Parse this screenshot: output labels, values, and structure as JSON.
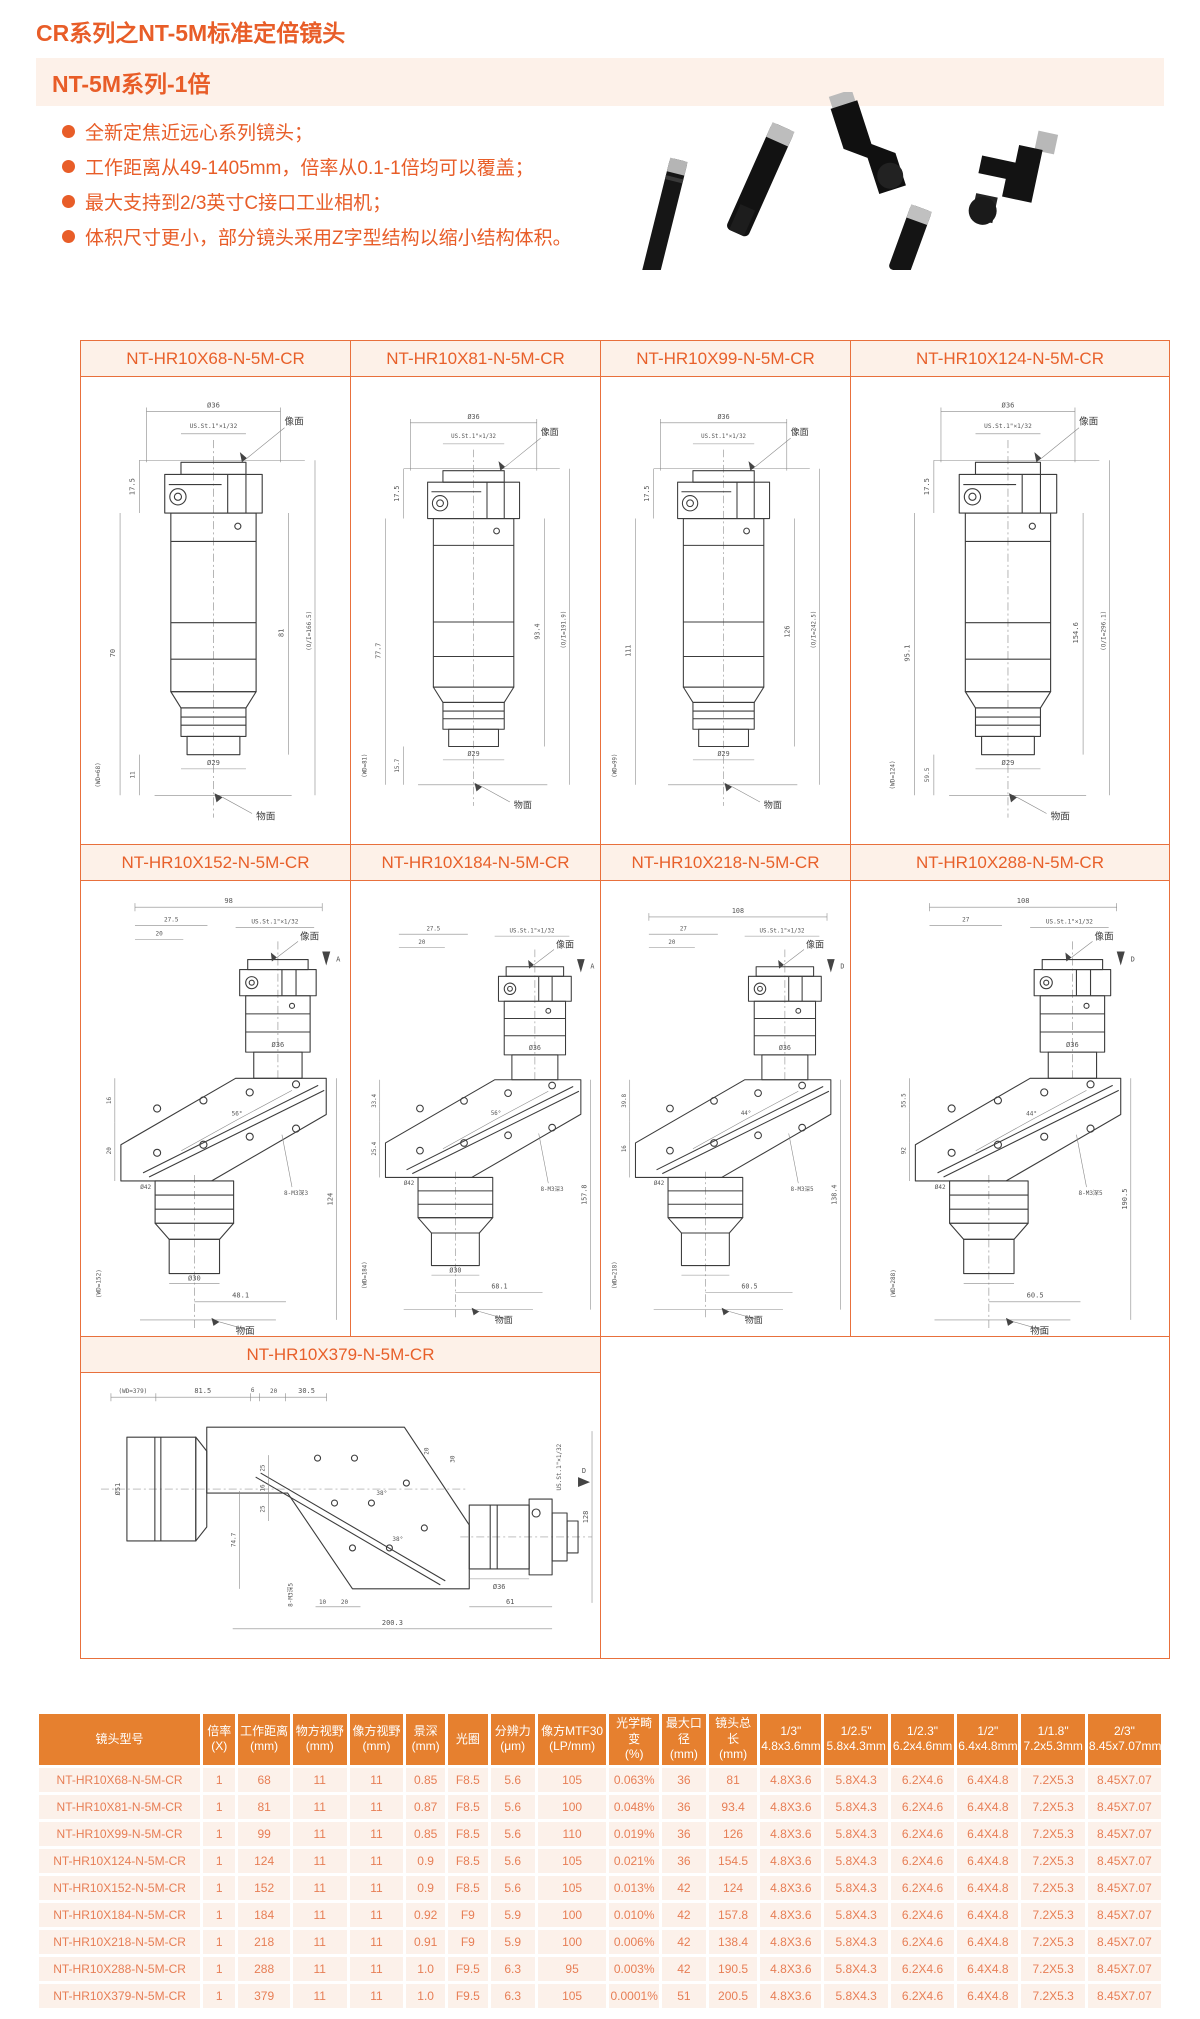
{
  "page": {
    "title": "CR系列之NT-5M标准定倍镜头",
    "banner": "NT-5M系列-1倍",
    "bullets": [
      "全新定焦近远心系列镜头；",
      "工作距离从49-1405mm，倍率从0.1-1倍均可以覆盖；",
      "最大支持到2/3英寸C接口工业相机；",
      "体积尺寸更小，部分镜头采用Z字型结构以缩小结构体积。"
    ]
  },
  "colors": {
    "accent": "#e85d28",
    "banner_bg": "#fdf1e9",
    "grid_border": "#e8703c",
    "grid_title_bg": "#fdf1e8",
    "table_header_bg": "#e6802f",
    "table_row_bg": "#fcf1ea",
    "table_text": "#e77e55"
  },
  "drawings": {
    "row1": [
      {
        "title": "NT-HR10X68-N-5M-CR",
        "dia_top": "Ø36",
        "mount": "US.St.1\"×1/32",
        "image_plane": "像面",
        "d1": "17.5",
        "d2": "70",
        "d3": "81",
        "oi": "(O/I=166.5)",
        "d4": "11",
        "wd": "(WD=68)",
        "dia_bot": "Ø29",
        "object_plane": "物面"
      },
      {
        "title": "NT-HR10X81-N-5M-CR",
        "dia_top": "Ø36",
        "mount": "US.St.1\"×1/32",
        "image_plane": "像面",
        "d1": "17.5",
        "d2": "77.7",
        "d3": "93.4",
        "oi": "(O/I=191.9)",
        "d4": "15.7",
        "wd": "(WD=81)",
        "dia_bot": "Ø29",
        "object_plane": "物面"
      },
      {
        "title": "NT-HR10X99-N-5M-CR",
        "dia_top": "Ø36",
        "mount": "US.St.1\"×1/32",
        "image_plane": "像面",
        "d1": "17.5",
        "d2": "111",
        "d3": "126",
        "oi": "(O/I=242.5)",
        "d4": "",
        "wd": "(WD=99)",
        "dia_bot": "Ø29",
        "object_plane": "物面"
      },
      {
        "title": "NT-HR10X124-N-5M-CR",
        "dia_top": "Ø36",
        "mount": "US.St.1\"×1/32",
        "image_plane": "像面",
        "d1": "17.5",
        "d2": "95.1",
        "d3": "154.6",
        "oi": "(O/I=296.1)",
        "d4": "59.5",
        "wd": "(WD=124)",
        "dia_bot": "Ø29",
        "object_plane": "物面"
      }
    ],
    "row2": [
      {
        "title": "NT-HR10X152-N-5M-CR",
        "w": "98",
        "t1": "27.5",
        "t2": "20",
        "mount": "US.St.1\"×1/32",
        "image_plane": "像面",
        "arrow": "A",
        "angle": "56°",
        "dia_mid": "Ø36",
        "dia1": "Ø42",
        "dia2": "Ø30",
        "l1": "16",
        "l2": "20",
        "note": "8-M3深3",
        "total": "124",
        "bottom": "48.1",
        "wd": "(WD=152)",
        "object_plane": "物面"
      },
      {
        "title": "NT-HR10X184-N-5M-CR",
        "w": "",
        "t1": "27.5",
        "t2": "20",
        "mount": "US.St.1\"×1/32",
        "image_plane": "像面",
        "arrow": "A",
        "angle": "56°",
        "dia_mid": "Ø36",
        "dia1": "Ø42",
        "dia2": "Ø30",
        "l1": "33.4",
        "l2": "25.4",
        "note": "8-M3深3",
        "total": "157.8",
        "bottom": "68.1",
        "wd": "(WD=184)",
        "object_plane": "物面"
      },
      {
        "title": "NT-HR10X218-N-5M-CR",
        "w": "108",
        "t1": "27",
        "t2": "20",
        "mount": "US.St.1\"×1/32",
        "image_plane": "像面",
        "arrow": "D",
        "angle": "44°",
        "dia_mid": "Ø36",
        "dia1": "Ø42",
        "dia2": "",
        "l1": "39.8",
        "l2": "16",
        "note": "8-M3深5",
        "total": "138.4",
        "bottom": "60.5",
        "wd": "(WD=218)",
        "object_plane": "物面"
      },
      {
        "title": "NT-HR10X288-N-5M-CR",
        "w": "108",
        "t1": "27",
        "t2": "",
        "mount": "US.St.1\"×1/32",
        "image_plane": "像面",
        "arrow": "D",
        "angle": "44°",
        "dia_mid": "Ø36",
        "dia1": "Ø42",
        "dia2": "",
        "l1": "55.5",
        "l2": "92",
        "note": "8-M3深5",
        "total": "190.5",
        "bottom": "60.5",
        "wd": "(WD=288)",
        "object_plane": "物面"
      }
    ],
    "row3": {
      "title": "NT-HR10X379-N-5M-CR",
      "wd": "(WD=379)",
      "t1": "81.5",
      "t2": "6",
      "t3": "20",
      "t4": "30.5",
      "dia_left": "Ø51",
      "v1": "25",
      "v2": "16",
      "v3": "25",
      "left_v": "74.7",
      "angle": "38°",
      "note": "8-M3深5",
      "b1": "10",
      "b2": "20",
      "b3": "61",
      "total": "200.3",
      "r1": "20",
      "r2": "30",
      "arrow": "D",
      "mount": "US.St.1\"×1/32",
      "right_v": "128",
      "dia_right": "Ø36"
    }
  },
  "table": {
    "headers": [
      {
        "l1": "镜头型号",
        "l2": ""
      },
      {
        "l1": "倍率",
        "l2": "(X)"
      },
      {
        "l1": "工作距离",
        "l2": "(mm)"
      },
      {
        "l1": "物方视野",
        "l2": "(mm)"
      },
      {
        "l1": "像方视野",
        "l2": "(mm)"
      },
      {
        "l1": "景深",
        "l2": "(mm)"
      },
      {
        "l1": "光圈",
        "l2": ""
      },
      {
        "l1": "分辨力",
        "l2": "(μm)"
      },
      {
        "l1": "像方MTF30",
        "l2": "(LP/mm)"
      },
      {
        "l1": "光学畸变",
        "l2": "(%)"
      },
      {
        "l1": "最大口径",
        "l2": "(mm)"
      },
      {
        "l1": "镜头总长",
        "l2": "(mm)"
      },
      {
        "l1": "1/3\"",
        "l2": "4.8x3.6mm"
      },
      {
        "l1": "1/2.5\"",
        "l2": "5.8x4.3mm"
      },
      {
        "l1": "1/2.3\"",
        "l2": "6.2x4.6mm"
      },
      {
        "l1": "1/2\"",
        "l2": "6.4x4.8mm"
      },
      {
        "l1": "1/1.8\"",
        "l2": "7.2x5.3mm"
      },
      {
        "l1": "2/3\"",
        "l2": "8.45x7.07mm"
      }
    ],
    "rows": [
      [
        "NT-HR10X68-N-5M-CR",
        "1",
        "68",
        "11",
        "11",
        "0.85",
        "F8.5",
        "5.6",
        "105",
        "0.063%",
        "36",
        "81",
        "4.8X3.6",
        "5.8X4.3",
        "6.2X4.6",
        "6.4X4.8",
        "7.2X5.3",
        "8.45X7.07"
      ],
      [
        "NT-HR10X81-N-5M-CR",
        "1",
        "81",
        "11",
        "11",
        "0.87",
        "F8.5",
        "5.6",
        "100",
        "0.048%",
        "36",
        "93.4",
        "4.8X3.6",
        "5.8X4.3",
        "6.2X4.6",
        "6.4X4.8",
        "7.2X5.3",
        "8.45X7.07"
      ],
      [
        "NT-HR10X99-N-5M-CR",
        "1",
        "99",
        "11",
        "11",
        "0.85",
        "F8.5",
        "5.6",
        "110",
        "0.019%",
        "36",
        "126",
        "4.8X3.6",
        "5.8X4.3",
        "6.2X4.6",
        "6.4X4.8",
        "7.2X5.3",
        "8.45X7.07"
      ],
      [
        "NT-HR10X124-N-5M-CR",
        "1",
        "124",
        "11",
        "11",
        "0.9",
        "F8.5",
        "5.6",
        "105",
        "0.021%",
        "36",
        "154.5",
        "4.8X3.6",
        "5.8X4.3",
        "6.2X4.6",
        "6.4X4.8",
        "7.2X5.3",
        "8.45X7.07"
      ],
      [
        "NT-HR10X152-N-5M-CR",
        "1",
        "152",
        "11",
        "11",
        "0.9",
        "F8.5",
        "5.6",
        "105",
        "0.013%",
        "42",
        "124",
        "4.8X3.6",
        "5.8X4.3",
        "6.2X4.6",
        "6.4X4.8",
        "7.2X5.3",
        "8.45X7.07"
      ],
      [
        "NT-HR10X184-N-5M-CR",
        "1",
        "184",
        "11",
        "11",
        "0.92",
        "F9",
        "5.9",
        "100",
        "0.010%",
        "42",
        "157.8",
        "4.8X3.6",
        "5.8X4.3",
        "6.2X4.6",
        "6.4X4.8",
        "7.2X5.3",
        "8.45X7.07"
      ],
      [
        "NT-HR10X218-N-5M-CR",
        "1",
        "218",
        "11",
        "11",
        "0.91",
        "F9",
        "5.9",
        "100",
        "0.006%",
        "42",
        "138.4",
        "4.8X3.6",
        "5.8X4.3",
        "6.2X4.6",
        "6.4X4.8",
        "7.2X5.3",
        "8.45X7.07"
      ],
      [
        "NT-HR10X288-N-5M-CR",
        "1",
        "288",
        "11",
        "11",
        "1.0",
        "F9.5",
        "6.3",
        "95",
        "0.003%",
        "42",
        "190.5",
        "4.8X3.6",
        "5.8X4.3",
        "6.2X4.6",
        "6.4X4.8",
        "7.2X5.3",
        "8.45X7.07"
      ],
      [
        "NT-HR10X379-N-5M-CR",
        "1",
        "379",
        "11",
        "11",
        "1.0",
        "F9.5",
        "6.3",
        "105",
        "0.0001%",
        "51",
        "200.5",
        "4.8X3.6",
        "5.8X4.3",
        "6.2X4.6",
        "6.4X4.8",
        "7.2X5.3",
        "8.45X7.07"
      ]
    ]
  }
}
